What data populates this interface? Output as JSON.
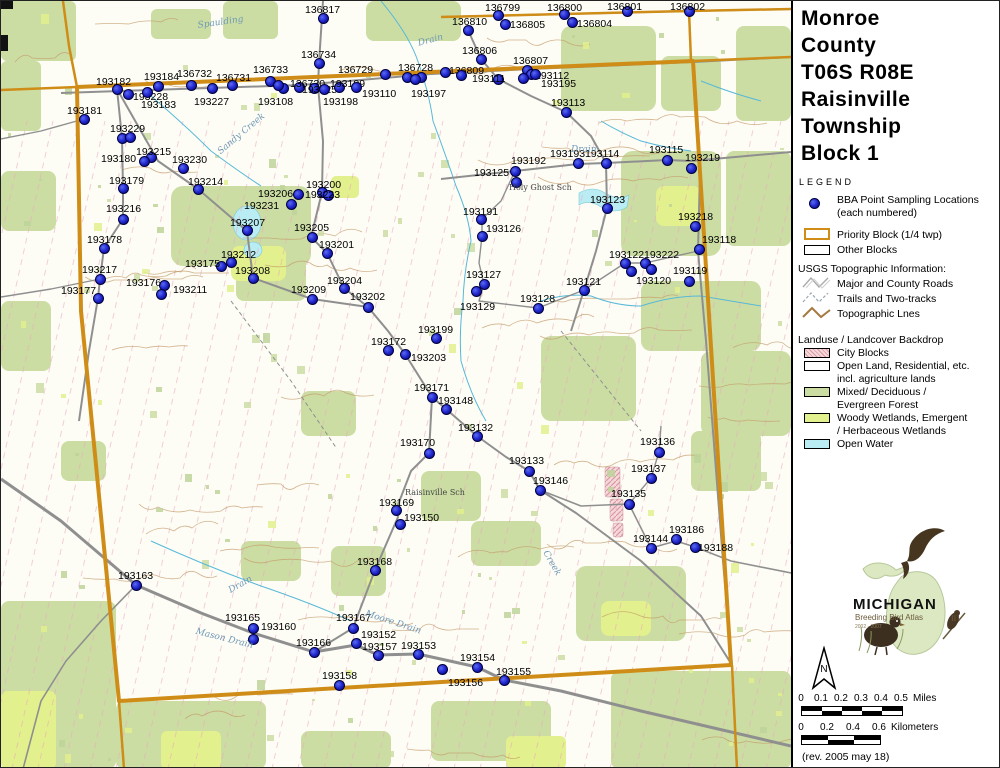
{
  "title_lines": [
    "Monroe",
    "County",
    "T06S R08E",
    "Raisinville",
    "Township",
    "Block 1"
  ],
  "legend": {
    "heading": "LEGEND",
    "points_item": {
      "line1": "BBA Point Sampling Locations",
      "line2": "(each numbered)"
    },
    "priority_block": "Priority Block (1/4 twp)",
    "other_blocks": "Other Blocks",
    "usgs_heading": "USGS Topographic Information:",
    "usgs_items": [
      "Major and County Roads",
      "Trails and Two-tracks",
      "Topographic Lnes"
    ],
    "landuse_heading": "Landuse / Landcover Backdrop",
    "landuse_items": [
      {
        "label1": "City Blocks",
        "label2": ""
      },
      {
        "label1": "Open Land, Residential, etc.",
        "label2": "incl. agriculture lands"
      },
      {
        "label1": "Mixed/ Deciduous /",
        "label2": "Evergreen Forest"
      },
      {
        "label1": "Woody Wetlands, Emergent",
        "label2": "/ Herbaceous Wetlands"
      },
      {
        "label1": "Open Water",
        "label2": ""
      }
    ]
  },
  "logo": {
    "name": "MICHIGAN",
    "subtitle": "Breeding Bird Atlas",
    "years": "2002 - 2007",
    "numeral": "II"
  },
  "north_label": "N",
  "scale": {
    "miles": {
      "ticks": [
        "0",
        "0.1",
        "0.2",
        "0.3",
        "0.4",
        "0.5"
      ],
      "unit": "Miles"
    },
    "km": {
      "ticks": [
        "0",
        "0.2",
        "0.4",
        "0.6"
      ],
      "unit": "Kilometers"
    }
  },
  "revision": "(rev. 2005 may 18)",
  "colors": {
    "priority_border_gold": "#cf8d18",
    "point_dot_blue": "#2222cc",
    "forest_green": "#cbdda3",
    "wetland_green": "#e2f08d",
    "open_water_blue": "#b9ecf3",
    "city_pink": "#f0c6cc",
    "road_gray": "#8f8f8f",
    "contour_brown": "#c49a6a",
    "section_line_pink": "#eaa9bd"
  },
  "map": {
    "points": [
      {
        "n": "136817",
        "d": [
          322,
          17
        ],
        "l": [
          304,
          3
        ]
      },
      {
        "n": "136810",
        "d": [
          467,
          29
        ],
        "l": [
          451,
          15
        ]
      },
      {
        "n": "136799",
        "d": [
          497,
          14
        ],
        "l": [
          484,
          1
        ]
      },
      {
        "n": "136805",
        "d": [
          504,
          23
        ],
        "l": [
          509,
          18
        ]
      },
      {
        "n": "136800",
        "d": [
          563,
          13
        ],
        "l": [
          546,
          1
        ]
      },
      {
        "n": "136804",
        "d": [
          571,
          21
        ],
        "l": [
          576,
          17
        ]
      },
      {
        "n": "136801",
        "d": [
          626,
          10
        ],
        "l": [
          606,
          0
        ]
      },
      {
        "n": "136802",
        "d": [
          688,
          10
        ],
        "l": [
          669,
          0
        ]
      },
      {
        "n": "136806",
        "d": [
          480,
          58
        ],
        "l": [
          461,
          44
        ]
      },
      {
        "n": "136734",
        "d": [
          318,
          62
        ],
        "l": [
          300,
          48
        ]
      },
      {
        "n": "136729",
        "d": [
          384,
          73
        ],
        "l": [
          337,
          63
        ]
      },
      {
        "n": "136728",
        "d": [
          406,
          76
        ],
        "l": [
          397,
          61
        ]
      },
      {
        "n": "136807",
        "d": [
          526,
          69
        ],
        "l": [
          512,
          54
        ]
      },
      {
        "n": "136809",
        "d": [
          444,
          71
        ],
        "l": [
          448,
          64
        ]
      },
      {
        "n": "193111",
        "d": [
          497,
          78
        ],
        "l": [
          471,
          72
        ]
      },
      {
        "n": "193112",
        "d": [
          530,
          73
        ],
        "l": [
          534,
          69
        ]
      },
      {
        "n": "193195",
        "d": [
          522,
          77
        ],
        "l": [
          540,
          77
        ]
      },
      {
        "n": "193113",
        "d": [
          565,
          111
        ],
        "l": [
          550,
          96
        ]
      },
      {
        "n": "193182",
        "d": [
          116,
          88
        ],
        "l": [
          95,
          75
        ]
      },
      {
        "n": "193228",
        "d": [
          127,
          93
        ],
        "l": [
          132,
          90
        ]
      },
      {
        "n": "193184",
        "d": [
          157,
          85
        ],
        "l": [
          143,
          70
        ]
      },
      {
        "n": "193183",
        "d": [
          146,
          91
        ],
        "l": [
          140,
          98
        ]
      },
      {
        "n": "136732",
        "d": [
          190,
          84
        ],
        "l": [
          176,
          67
        ]
      },
      {
        "n": "136731",
        "d": [
          231,
          84
        ],
        "l": [
          215,
          71
        ]
      },
      {
        "n": "193227",
        "d": [
          211,
          87
        ],
        "l": [
          193,
          95
        ]
      },
      {
        "n": "136733",
        "d": [
          269,
          80
        ],
        "l": [
          252,
          63
        ]
      },
      {
        "n": "193108",
        "d": [
          282,
          87
        ],
        "l": [
          257,
          95
        ]
      },
      {
        "n": "136730",
        "d": [
          298,
          86
        ],
        "l": [
          289,
          77
        ]
      },
      {
        "n": "193225",
        "d": [
          313,
          87
        ],
        "l": [
          301,
          83
        ]
      },
      {
        "n": "193109",
        "d": [
          338,
          86
        ],
        "l": [
          329,
          77
        ]
      },
      {
        "n": "193110",
        "d": [
          355,
          86
        ],
        "l": [
          361,
          87
        ]
      },
      {
        "n": "193198",
        "d": [
          323,
          88
        ],
        "l": [
          322,
          95
        ]
      },
      {
        "n": "193197",
        "d": [
          420,
          76
        ],
        "l": [
          410,
          87
        ]
      },
      {
        "n": "193181",
        "d": [
          83,
          118
        ],
        "l": [
          66,
          104
        ]
      },
      {
        "n": "193229",
        "d": [
          121,
          137
        ],
        "l": [
          109,
          122
        ]
      },
      {
        "n": "193215",
        "d": [
          150,
          156
        ],
        "l": [
          135,
          145
        ]
      },
      {
        "n": "193180",
        "d": [
          143,
          160
        ],
        "l": [
          100,
          152
        ]
      },
      {
        "n": "193230",
        "d": [
          182,
          167
        ],
        "l": [
          171,
          153
        ]
      },
      {
        "n": "193179",
        "d": [
          122,
          187
        ],
        "l": [
          108,
          174
        ]
      },
      {
        "n": "193214",
        "d": [
          197,
          188
        ],
        "l": [
          187,
          175
        ]
      },
      {
        "n": "193216",
        "d": [
          122,
          218
        ],
        "l": [
          105,
          202
        ]
      },
      {
        "n": "193178",
        "d": [
          103,
          247
        ],
        "l": [
          86,
          233
        ]
      },
      {
        "n": "193217",
        "d": [
          99,
          278
        ],
        "l": [
          81,
          263
        ]
      },
      {
        "n": "193177",
        "d": [
          97,
          297
        ],
        "l": [
          60,
          284
        ]
      },
      {
        "n": "193176",
        "d": [
          163,
          284
        ],
        "l": [
          125,
          276
        ]
      },
      {
        "n": "193211",
        "d": [
          160,
          293
        ],
        "l": [
          172,
          283
        ]
      },
      {
        "n": "193175",
        "d": [
          220,
          265
        ],
        "l": [
          184,
          257
        ]
      },
      {
        "n": "193212",
        "d": [
          230,
          261
        ],
        "l": [
          220,
          248
        ]
      },
      {
        "n": "193208",
        "d": [
          252,
          277
        ],
        "l": [
          234,
          264
        ]
      },
      {
        "n": "193206",
        "d": [
          297,
          193
        ],
        "l": [
          257,
          187
        ]
      },
      {
        "n": "193231",
        "d": [
          290,
          203
        ],
        "l": [
          243,
          199
        ]
      },
      {
        "n": "193207",
        "d": [
          246,
          229
        ],
        "l": [
          229,
          216
        ]
      },
      {
        "n": "193200",
        "d": [
          321,
          191
        ],
        "l": [
          305,
          178
        ]
      },
      {
        "n": "193223",
        "d": [
          327,
          194
        ],
        "l": [
          304,
          188
        ]
      },
      {
        "n": "193205",
        "d": [
          311,
          236
        ],
        "l": [
          293,
          221
        ]
      },
      {
        "n": "193201",
        "d": [
          326,
          252
        ],
        "l": [
          318,
          238
        ]
      },
      {
        "n": "193204",
        "d": [
          343,
          287
        ],
        "l": [
          326,
          274
        ]
      },
      {
        "n": "193209",
        "d": [
          311,
          298
        ],
        "l": [
          290,
          283
        ]
      },
      {
        "n": "193202",
        "d": [
          367,
          306
        ],
        "l": [
          349,
          290
        ]
      },
      {
        "n": "193199",
        "d": [
          435,
          337
        ],
        "l": [
          417,
          323
        ]
      },
      {
        "n": "193172",
        "d": [
          387,
          349
        ],
        "l": [
          370,
          335
        ]
      },
      {
        "n": "193203",
        "d": [
          404,
          353
        ],
        "l": [
          410,
          351
        ]
      },
      {
        "n": "193171",
        "d": [
          431,
          396
        ],
        "l": [
          413,
          381
        ]
      },
      {
        "n": "193148",
        "d": [
          445,
          408
        ],
        "l": [
          437,
          394
        ]
      },
      {
        "n": "193132",
        "d": [
          476,
          435
        ],
        "l": [
          457,
          421
        ]
      },
      {
        "n": "193170",
        "d": [
          428,
          452
        ],
        "l": [
          399,
          436
        ]
      },
      {
        "n": "193169",
        "d": [
          395,
          509
        ],
        "l": [
          378,
          496
        ]
      },
      {
        "n": "193150",
        "d": [
          399,
          523
        ],
        "l": [
          403,
          511
        ]
      },
      {
        "n": "193168",
        "d": [
          374,
          569
        ],
        "l": [
          356,
          555
        ]
      },
      {
        "n": "193192",
        "d": [
          514,
          170
        ],
        "l": [
          510,
          154
        ]
      },
      {
        "n": "193125",
        "d": [
          515,
          181
        ],
        "l": [
          473,
          166
        ]
      },
      {
        "n": "193193",
        "d": [
          577,
          162
        ],
        "l": [
          549,
          147
        ]
      },
      {
        "n": "193114",
        "d": [
          605,
          162
        ],
        "l": [
          584,
          147
        ]
      },
      {
        "n": "193115",
        "d": [
          666,
          159
        ],
        "l": [
          648,
          143
        ]
      },
      {
        "n": "193219",
        "d": [
          690,
          167
        ],
        "l": [
          684,
          151
        ]
      },
      {
        "n": "193123",
        "d": [
          606,
          207
        ],
        "l": [
          589,
          193
        ]
      },
      {
        "n": "193191",
        "d": [
          480,
          218
        ],
        "l": [
          462,
          205
        ]
      },
      {
        "n": "193126",
        "d": [
          481,
          235
        ],
        "l": [
          485,
          222
        ]
      },
      {
        "n": "193218",
        "d": [
          694,
          225
        ],
        "l": [
          677,
          210
        ]
      },
      {
        "n": "193118",
        "d": [
          698,
          248
        ],
        "l": [
          701,
          233
        ]
      },
      {
        "n": "193127",
        "d": [
          483,
          283
        ],
        "l": [
          465,
          268
        ]
      },
      {
        "n": "193129",
        "d": [
          475,
          290
        ],
        "l": [
          459,
          300
        ]
      },
      {
        "n": "193128",
        "d": [
          537,
          307
        ],
        "l": [
          519,
          292
        ]
      },
      {
        "n": "193121",
        "d": [
          583,
          289
        ],
        "l": [
          565,
          275
        ]
      },
      {
        "n": "193122",
        "d": [
          624,
          262
        ],
        "l": [
          608,
          248
        ]
      },
      {
        "n": "193222",
        "d": [
          644,
          262
        ],
        "l": [
          643,
          248
        ]
      },
      {
        "n": "193120",
        "d": [
          630,
          270
        ],
        "l": [
          635,
          274
        ]
      },
      {
        "n": "193119",
        "d": [
          688,
          280
        ],
        "l": [
          672,
          264
        ]
      },
      {
        "n": "193133",
        "d": [
          528,
          470
        ],
        "l": [
          508,
          454
        ]
      },
      {
        "n": "193146",
        "d": [
          539,
          489
        ],
        "l": [
          532,
          474
        ]
      },
      {
        "n": "193136",
        "d": [
          658,
          451
        ],
        "l": [
          639,
          435
        ]
      },
      {
        "n": "193137",
        "d": [
          650,
          477
        ],
        "l": [
          630,
          462
        ]
      },
      {
        "n": "193135",
        "d": [
          628,
          503
        ],
        "l": [
          610,
          487
        ]
      },
      {
        "n": "193144",
        "d": [
          650,
          547
        ],
        "l": [
          632,
          532
        ]
      },
      {
        "n": "193186",
        "d": [
          675,
          538
        ],
        "l": [
          668,
          523
        ]
      },
      {
        "n": "193188",
        "d": [
          694,
          546
        ],
        "l": [
          697,
          541
        ]
      },
      {
        "n": "193163",
        "d": [
          135,
          584
        ],
        "l": [
          117,
          569
        ]
      },
      {
        "n": "193165",
        "d": [
          252,
          627
        ],
        "l": [
          224,
          611
        ]
      },
      {
        "n": "193160",
        "d": [
          252,
          638
        ],
        "l": [
          260,
          620
        ]
      },
      {
        "n": "193166",
        "d": [
          313,
          651
        ],
        "l": [
          295,
          636
        ]
      },
      {
        "n": "193167",
        "d": [
          352,
          627
        ],
        "l": [
          335,
          611
        ]
      },
      {
        "n": "193152",
        "d": [
          355,
          642
        ],
        "l": [
          360,
          628
        ]
      },
      {
        "n": "193157",
        "d": [
          377,
          654
        ],
        "l": [
          361,
          640
        ]
      },
      {
        "n": "193153",
        "d": [
          417,
          653
        ],
        "l": [
          400,
          639
        ]
      },
      {
        "n": "193154",
        "d": [
          476,
          666
        ],
        "l": [
          459,
          651
        ]
      },
      {
        "n": "193155",
        "d": [
          503,
          679
        ],
        "l": [
          495,
          665
        ]
      },
      {
        "n": "193156",
        "d": [
          441,
          668
        ],
        "l": [
          447,
          676
        ]
      },
      {
        "n": "193158",
        "d": [
          338,
          684
        ],
        "l": [
          321,
          669
        ]
      }
    ],
    "extra_dots": [
      [
        277,
        84
      ],
      [
        534,
        73
      ],
      [
        460,
        74
      ],
      [
        129,
        136
      ],
      [
        650,
        268
      ],
      [
        414,
        78
      ]
    ],
    "place_labels": [
      {
        "t": "Spaulding",
        "x": 196,
        "y": 20,
        "r": -8,
        "cls": "wtr"
      },
      {
        "t": "Drain",
        "x": 416,
        "y": 38,
        "r": -15,
        "cls": "wtr"
      },
      {
        "t": "Sandy Creek",
        "x": 215,
        "y": 148,
        "r": -40,
        "cls": "wtr"
      },
      {
        "t": "Drain",
        "x": 570,
        "y": 144,
        "r": 0,
        "cls": "wtr"
      },
      {
        "t": "Holy Ghost Sch",
        "x": 508,
        "y": 182,
        "r": 0,
        "cls": "plc"
      },
      {
        "t": "Raisinville Sch",
        "x": 404,
        "y": 487,
        "r": 0,
        "cls": "plc"
      },
      {
        "t": "Moore Drain",
        "x": 366,
        "y": 608,
        "r": 18,
        "cls": "wtr"
      },
      {
        "t": "Mason Drain",
        "x": 196,
        "y": 626,
        "r": 14,
        "cls": "wtr"
      },
      {
        "t": "Drain",
        "x": 226,
        "y": 586,
        "r": -30,
        "cls": "wtr"
      },
      {
        "t": "Creek",
        "x": 548,
        "y": 548,
        "r": 60,
        "cls": "wtr"
      }
    ]
  }
}
